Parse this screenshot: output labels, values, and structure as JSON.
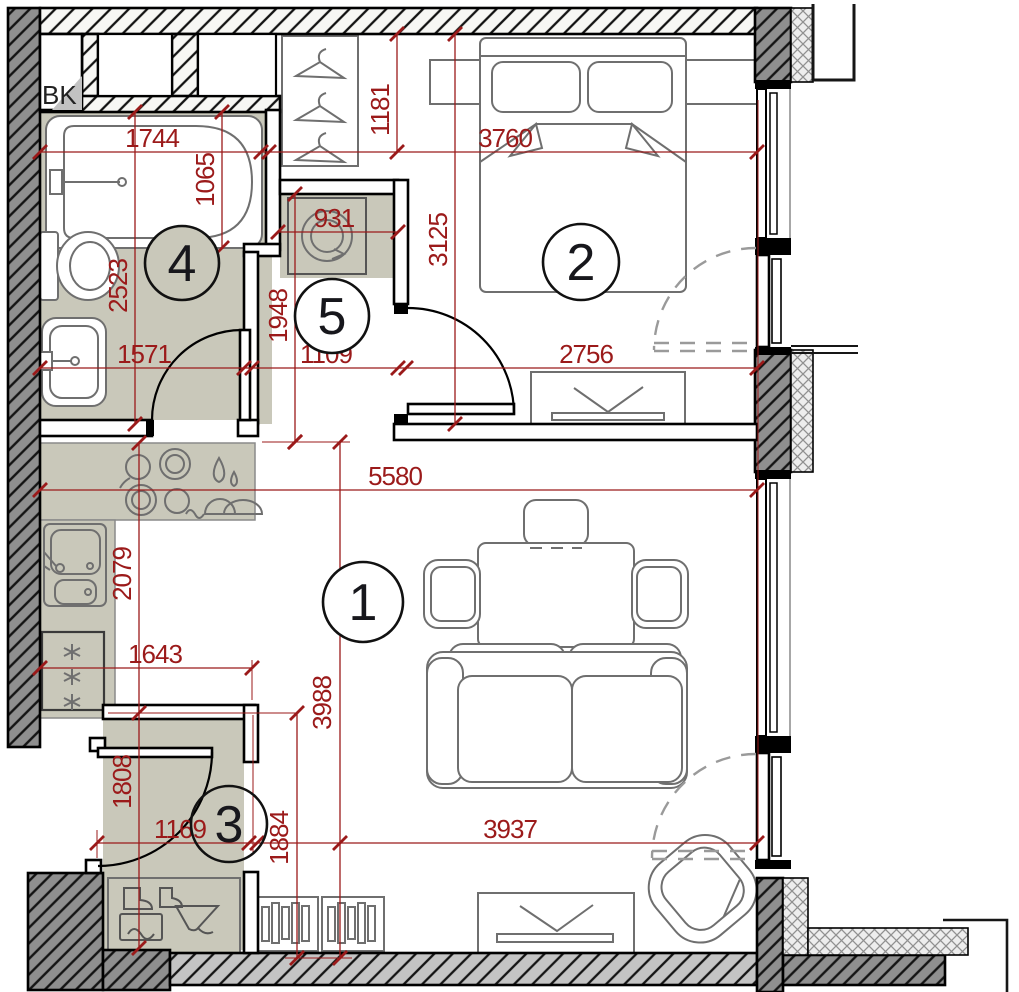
{
  "drawing": {
    "labels": {
      "shaft": "BK"
    },
    "rooms": {
      "living": "1",
      "bedroom": "2",
      "entry": "3",
      "bathroom": "4",
      "hallway": "5"
    },
    "dimensions": {
      "bath_top": "1744",
      "tub_width": "1065",
      "bath_height": "2523",
      "bath_bottom": "1571",
      "wardrobe_depth": "1181",
      "bedroom_top": "3760",
      "bedroom_height": "3125",
      "bedroom_bottom": "2756",
      "washer_niche": "931",
      "hall_height": "1948",
      "hall_width": "1109",
      "living_top": "5580",
      "living_height": "3988",
      "living_bottom": "3937",
      "kitchen_height": "2079",
      "kitchen_width": "1643",
      "entry_height": "1808",
      "entry_width": "1169",
      "entry_right_height": "1884"
    },
    "colors": {
      "dimension_red": "#9B1A1A",
      "room_shade": "#C9C8BA",
      "wall_dark": "#8F8F8F"
    }
  }
}
